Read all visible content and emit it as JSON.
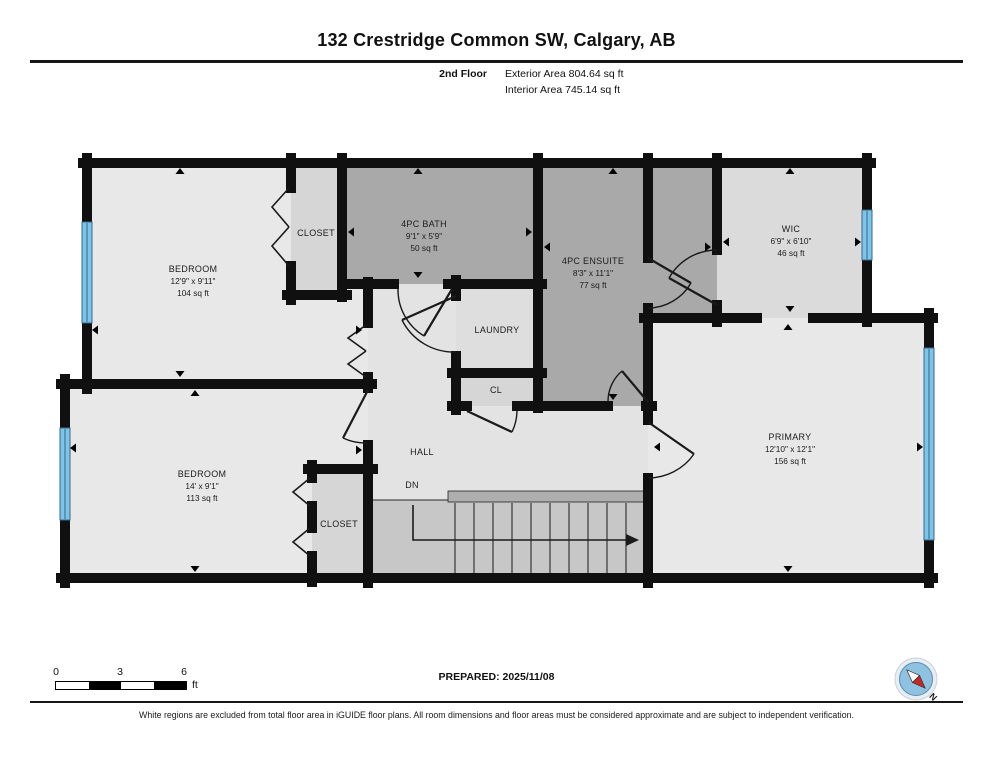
{
  "header": {
    "title": "132 Crestridge Common SW, Calgary, AB",
    "floor_label": "2nd Floor",
    "exterior_area": "Exterior Area 804.64 sq ft",
    "interior_area": "Interior Area 745.14 sq ft"
  },
  "rooms": {
    "bedroom_top": {
      "name": "BEDROOM",
      "dims": "12'9\" x 9'11\"",
      "area": "104 sq ft"
    },
    "closet_top": {
      "name": "CLOSET"
    },
    "bath": {
      "name": "4PC BATH",
      "dims": "9'1\" x 5'9\"",
      "area": "50 sq ft"
    },
    "ensuite": {
      "name": "4PC ENSUITE",
      "dims": "8'3\" x 11'1\"",
      "area": "77 sq ft"
    },
    "wic": {
      "name": "WIC",
      "dims": "6'9\" x 6'10\"",
      "area": "46 sq ft"
    },
    "laundry": {
      "name": "LAUNDRY"
    },
    "cl": {
      "name": "CL"
    },
    "hall": {
      "name": "HALL"
    },
    "stairs": {
      "label": "DN"
    },
    "primary": {
      "name": "PRIMARY",
      "dims": "12'10\" x 12'1\"",
      "area": "156 sq ft"
    },
    "bedroom_lower": {
      "name": "BEDROOM",
      "dims": "14' x 9'1\"",
      "area": "113 sq ft"
    },
    "closet_lower": {
      "name": "CLOSET"
    }
  },
  "footer": {
    "scale": {
      "tick0": "0",
      "tick3": "3",
      "tick6": "6",
      "unit": "ft"
    },
    "prepared": "PREPARED: 2025/11/08",
    "compass_label": "N",
    "disclaimer": "White regions are excluded from total floor area in iGUIDE floor plans. All room dimensions and floor areas must be considered approximate and are subject to independent verification."
  },
  "colors": {
    "wall": "#101010",
    "room_light": "#e8e8e8",
    "room_medium": "#d6d6d6",
    "room_dark": "#a9a9a9",
    "hall": "#e3e3e3",
    "laundry": "#dedede",
    "wic": "#dbdbdb",
    "stairs": "#c7c7c7",
    "stair_landing": "#aeaeae",
    "window_blue": "#7ec3e8",
    "window_frame": "#33688c",
    "compass_ring": "#e6edf3",
    "compass_blue": "#8fc1e0",
    "compass_red": "#c62828"
  }
}
